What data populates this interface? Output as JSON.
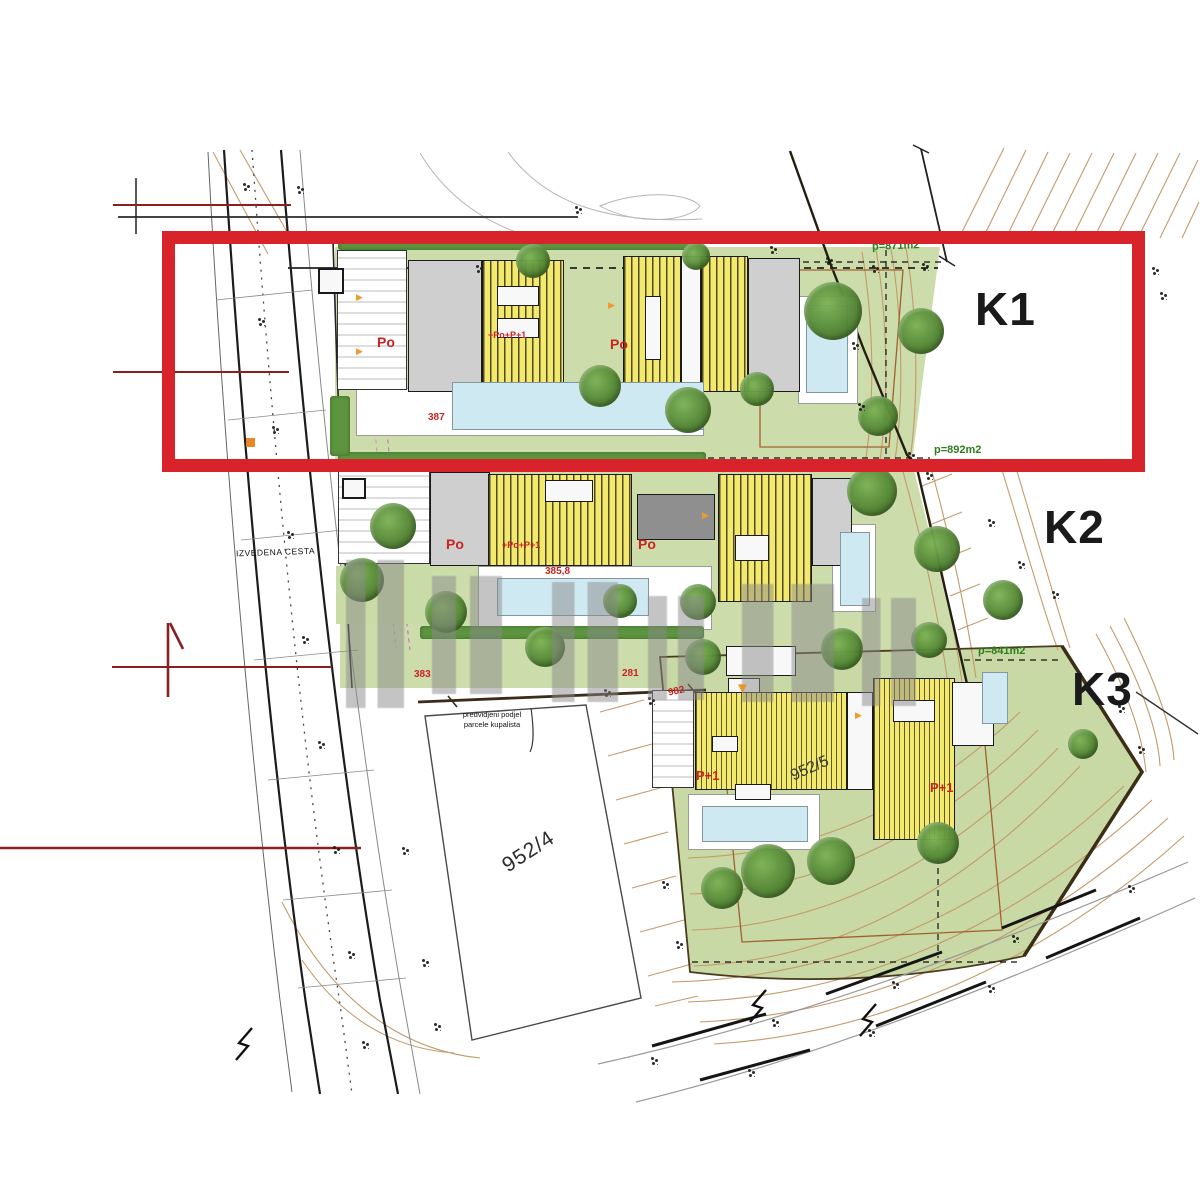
{
  "plan": {
    "labels": {
      "k1": "K1",
      "k2": "K2",
      "k3": "K3"
    },
    "area": {
      "k1": "p=871m2",
      "k2": "p=892m2",
      "k3": "p=841m2"
    },
    "parcels": {
      "p1": "952/4",
      "p2": "952/5"
    },
    "road": "IZVEDENA CESTA",
    "callout": {
      "l1": "predvidjeni podjel",
      "l2": "parcele kupalista"
    },
    "po": "Po",
    "p1": "P+1",
    "annot": "+Po+P+1",
    "nums": {
      "n1": "387",
      "n2": "385,8",
      "n3": "383",
      "n4": "281",
      "n5": "982"
    },
    "v": "▼",
    "tri": "▶",
    "colors": {
      "highlight": "#d8232a",
      "plot_green": "#ccdcab",
      "roof_yellow": "#f3e96d",
      "pool_blue": "#cfe9f3",
      "contour": "#c49a6a",
      "area_label_green": "#2e7d1f",
      "red_text": "#cc2222"
    }
  }
}
